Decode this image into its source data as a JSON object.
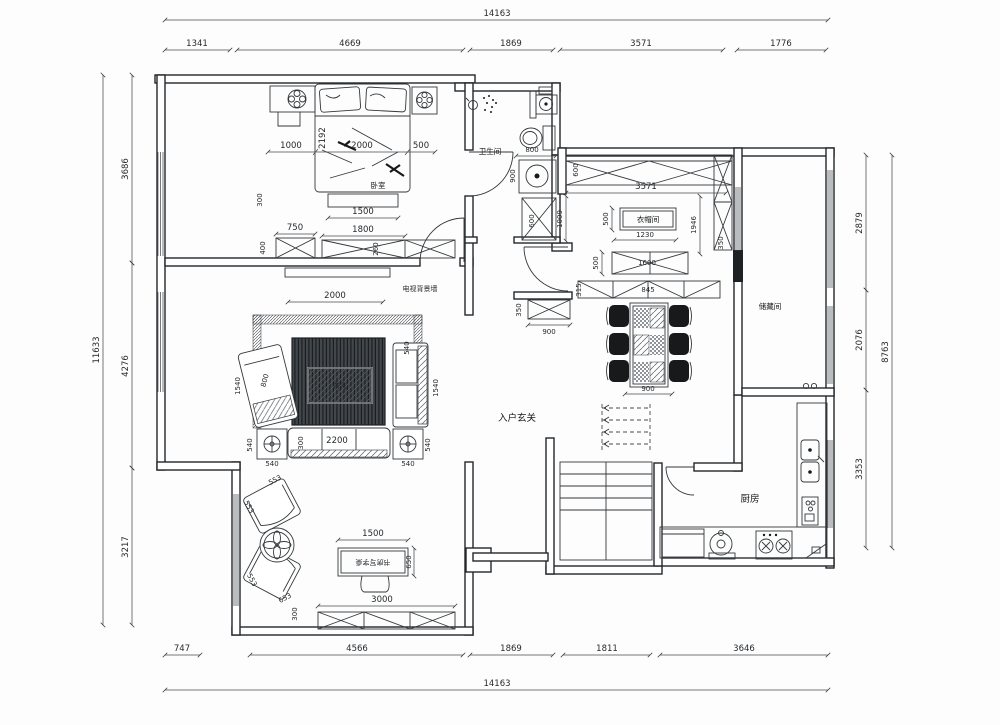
{
  "title": "residential-floor-plan",
  "colors": {
    "line": "#2e3338",
    "rug": "#41464b",
    "chair": "#17191b",
    "dim_text": "#26292c"
  },
  "dims": {
    "top_total": "14163",
    "top": [
      "1341",
      "4669",
      "1869",
      "3571",
      "1776"
    ],
    "bottom": [
      "747",
      "4566",
      "1869",
      "1811",
      "3646"
    ],
    "bottom_total": "14163",
    "left_total": "11633",
    "left": [
      "3686",
      "4276",
      "3217"
    ],
    "right": [
      "2879",
      "2076",
      "3353"
    ],
    "right_total": "8763"
  },
  "bedroom": {
    "label": "卧室",
    "row": [
      "1000",
      "2192",
      "2000",
      "500"
    ],
    "bench": "1500",
    "cab_small": "750",
    "cab_big": "1800",
    "side_a": "400",
    "side_b": "300",
    "side_c": "260"
  },
  "living": {
    "wall_label": "电视背景墙",
    "tv": "2000",
    "chaise_l": "1540",
    "chaise_w": "800",
    "right_l": "1540",
    "right_w": "540",
    "sofa": "2200",
    "sofa_d": "300",
    "t540": [
      "540",
      "540",
      "540",
      "540"
    ],
    "table_label": "茶几"
  },
  "study": {
    "chairs": [
      "553",
      "553",
      "553",
      "653"
    ],
    "side": "300",
    "desk_w": "1500",
    "desk_d": "650",
    "cab": "3000",
    "desk_label": "书房写字桌"
  },
  "bath": {
    "label": "卫生间",
    "d800": "800",
    "d900": "900",
    "d600": "600"
  },
  "foyer": {
    "label": "入户玄关",
    "d1009": "1009",
    "shoe_d": "350",
    "shoe_w": "900"
  },
  "cloak": {
    "label": "衣帽间",
    "depth": "600",
    "width": "3571",
    "island_d": "500",
    "island_w": "1230",
    "right_h": "1946",
    "right_d": "350"
  },
  "dining": {
    "cab_d": "500",
    "cab_w": "1600",
    "counter": "845",
    "counter_d": "315",
    "table_w": "900"
  },
  "kitchen": {
    "label": "厨房"
  },
  "storage": {
    "label": "储藏间"
  }
}
